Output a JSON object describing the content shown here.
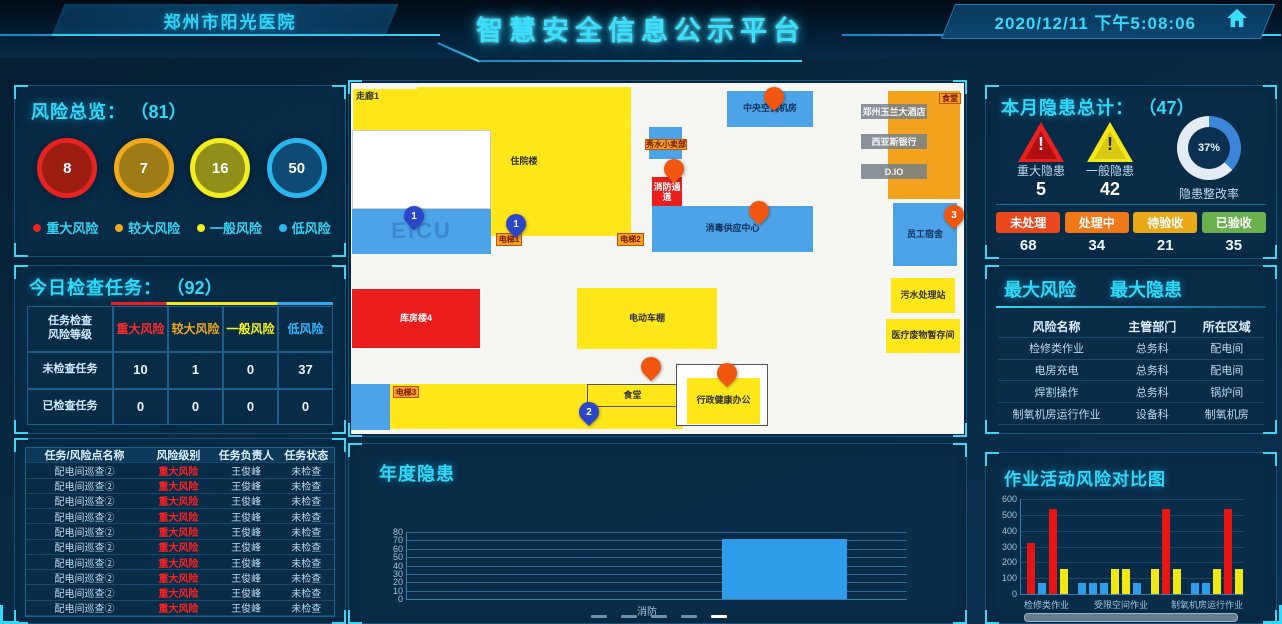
{
  "header": {
    "hospital": "郑州市阳光医院",
    "title": "智慧安全信息公示平台",
    "datetime": "2020/12/11 下午5:08:06"
  },
  "risk_overview": {
    "title": "风险总览：",
    "total": "（81）",
    "items": [
      {
        "value": "8",
        "label": "重大风险",
        "ring": "#e62222",
        "fill": "#9c1d12"
      },
      {
        "value": "7",
        "label": "较大风险",
        "ring": "#f0a81e",
        "fill": "#9c7a16"
      },
      {
        "value": "16",
        "label": "一般风险",
        "ring": "#f0ee1e",
        "fill": "#8f8f1a"
      },
      {
        "value": "50",
        "label": "低风险",
        "ring": "#29b6f0",
        "fill": "#0e4a74"
      }
    ]
  },
  "today_tasks": {
    "title": "今日检查任务：",
    "total": "（92）",
    "corner_top": "任务检查",
    "corner_bottom": "风险等级",
    "columns": [
      {
        "label": "重大风险",
        "color": "#ff2a2a"
      },
      {
        "label": "较大风险",
        "color": "#f0a81e"
      },
      {
        "label": "一般风险",
        "color": "#f5f51e"
      },
      {
        "label": "低风险",
        "color": "#35b6ff"
      }
    ],
    "rows": [
      {
        "label": "未检查任务",
        "values": [
          "10",
          "1",
          "0",
          "37"
        ]
      },
      {
        "label": "已检查任务",
        "values": [
          "0",
          "0",
          "0",
          "0"
        ]
      }
    ]
  },
  "task_detail": {
    "headers": [
      "任务/风险点名称",
      "风险级别",
      "任务负责人",
      "任务状态"
    ],
    "rows": [
      [
        "配电间巡查②",
        "重大风险",
        "王俊峰",
        "未检查"
      ],
      [
        "配电间巡查②",
        "重大风险",
        "王俊峰",
        "未检查"
      ],
      [
        "配电间巡查②",
        "重大风险",
        "王俊峰",
        "未检查"
      ],
      [
        "配电间巡查②",
        "重大风险",
        "王俊峰",
        "未检查"
      ],
      [
        "配电间巡查②",
        "重大风险",
        "王俊峰",
        "未检查"
      ],
      [
        "配电间巡查②",
        "重大风险",
        "王俊峰",
        "未检查"
      ],
      [
        "配电间巡查②",
        "重大风险",
        "王俊峰",
        "未检查"
      ],
      [
        "配电间巡查②",
        "重大风险",
        "王俊峰",
        "未检查"
      ],
      [
        "配电间巡查②",
        "重大风险",
        "王俊峰",
        "未检查"
      ],
      [
        "配电间巡查②",
        "重大风险",
        "王俊峰",
        "未检查"
      ]
    ]
  },
  "monthly_hazard": {
    "title": "本月隐患总计：",
    "total": "（47）",
    "major": {
      "label": "重大隐患",
      "value": "5"
    },
    "general": {
      "label": "一般隐患",
      "value": "42"
    },
    "donut": {
      "percent": "37%",
      "label": "隐患整改率",
      "arc_color": "#3b86d8",
      "rest_color": "#e3ebf3"
    },
    "badges": [
      {
        "label": "未处理",
        "value": "68",
        "color": "#e8481c"
      },
      {
        "label": "处理中",
        "value": "34",
        "color": "#f07818"
      },
      {
        "label": "待验收",
        "value": "21",
        "color": "#e8a818"
      },
      {
        "label": "已验收",
        "value": "35",
        "color": "#6ab04c"
      }
    ]
  },
  "top_risk": {
    "tab_risk": "最大风险",
    "tab_hazard": "最大隐患",
    "headers": [
      "风险名称",
      "主管部门",
      "所在区域"
    ],
    "rows": [
      [
        "检修类作业",
        "总务科",
        "配电间"
      ],
      [
        "电房充电",
        "总务科",
        "配电间"
      ],
      [
        "焊割操作",
        "总务科",
        "锅炉间"
      ],
      [
        "制氧机房运行作业",
        "设备科",
        "制氧机房"
      ]
    ]
  },
  "map": {
    "blocks": [
      {
        "x": 2,
        "y": 6,
        "w": 88,
        "h": 57,
        "c": "#ffe71a",
        "label": "走廊1",
        "cls": "tl"
      },
      {
        "x": 66,
        "y": 4,
        "w": 214,
        "h": 149,
        "c": "#ffe71a",
        "label": "住院楼"
      },
      {
        "x": 1,
        "y": 47,
        "w": 139,
        "h": 79,
        "c": "#ffffff",
        "label": "",
        "border": "#cccccc"
      },
      {
        "x": 1,
        "y": 126,
        "w": 139,
        "h": 45,
        "c": "#4da3e8",
        "label": "",
        "big": "EICU"
      },
      {
        "x": 376,
        "y": 8,
        "w": 86,
        "h": 36,
        "c": "#4da3e8",
        "label": "中央空调机房",
        "lc": "#10325e"
      },
      {
        "x": 298,
        "y": 44,
        "w": 33,
        "h": 32,
        "c": "#4da3e8",
        "label": ""
      },
      {
        "x": 301,
        "y": 94,
        "w": 30,
        "h": 32,
        "c": "#ea1c1c",
        "label": "消防通道",
        "lc": "#ffffff"
      },
      {
        "x": 301,
        "y": 123,
        "w": 161,
        "h": 46,
        "c": "#4da3e8",
        "label": "消毒供应中心",
        "lc": "#10325e"
      },
      {
        "x": 537,
        "y": 8,
        "w": 72,
        "h": 108,
        "c": "#f2a21c",
        "label": ""
      },
      {
        "x": 542,
        "y": 120,
        "w": 64,
        "h": 63,
        "c": "#4da3e8",
        "label": "员工宿舍",
        "lc": "#10325e"
      },
      {
        "x": 540,
        "y": 195,
        "w": 64,
        "h": 35,
        "c": "#ffe71a",
        "label": "污水处理站"
      },
      {
        "x": 535,
        "y": 236,
        "w": 74,
        "h": 34,
        "c": "#ffe71a",
        "label": "医疗废物暂存间"
      },
      {
        "x": 1,
        "y": 206,
        "w": 128,
        "h": 59,
        "c": "#ea1c1c",
        "label": "库房楼4",
        "lc": "#ffffff"
      },
      {
        "x": 226,
        "y": 205,
        "w": 140,
        "h": 61,
        "c": "#ffe71a",
        "label": "电动车棚"
      },
      {
        "x": 0,
        "y": 301,
        "w": 39,
        "h": 46,
        "c": "#4da3e8",
        "label": ""
      },
      {
        "x": 39,
        "y": 301,
        "w": 293,
        "h": 45,
        "c": "#ffe71a",
        "label": ""
      },
      {
        "x": 236,
        "y": 301,
        "w": 91,
        "h": 23,
        "c": "#ffe71a",
        "label": "食堂",
        "border": "#555555"
      },
      {
        "x": 325,
        "y": 281,
        "w": 92,
        "h": 62,
        "c": "#ffffff",
        "label": "",
        "border": "#555555"
      },
      {
        "x": 336,
        "y": 295,
        "w": 73,
        "h": 46,
        "c": "#ffe71a",
        "label": "行政健康办公"
      }
    ],
    "tags": [
      {
        "x": 294,
        "y": 56,
        "w": 42,
        "h": 11,
        "label": "秀水小卖部"
      },
      {
        "x": 588,
        "y": 10,
        "w": 22,
        "h": 11,
        "label": "食堂"
      },
      {
        "x": 42,
        "y": 303,
        "w": 26,
        "h": 12,
        "label": "电梯3"
      },
      {
        "x": 145,
        "y": 150,
        "w": 26,
        "h": 13,
        "label": "电梯1"
      },
      {
        "x": 266,
        "y": 150,
        "w": 27,
        "h": 13,
        "label": "电梯2"
      }
    ],
    "graybars": [
      {
        "x": 510,
        "y": 21,
        "w": 66,
        "h": 15,
        "label": "郑州玉兰大酒店"
      },
      {
        "x": 510,
        "y": 51,
        "w": 66,
        "h": 15,
        "label": "西亚斯银行"
      },
      {
        "x": 510,
        "y": 81,
        "w": 66,
        "h": 15,
        "label": "D.IO"
      }
    ],
    "pins": [
      {
        "x": 53,
        "y": 123,
        "t": "blue",
        "n": "1"
      },
      {
        "x": 155,
        "y": 131,
        "t": "blue",
        "n": "1"
      },
      {
        "x": 313,
        "y": 76,
        "t": "orange",
        "n": ""
      },
      {
        "x": 413,
        "y": 4,
        "t": "orange",
        "n": ""
      },
      {
        "x": 398,
        "y": 118,
        "t": "orange",
        "n": ""
      },
      {
        "x": 593,
        "y": 122,
        "t": "orange",
        "n": "3"
      },
      {
        "x": 290,
        "y": 274,
        "t": "orange",
        "n": ""
      },
      {
        "x": 366,
        "y": 280,
        "t": "orange",
        "n": ""
      },
      {
        "x": 228,
        "y": 319,
        "t": "blue",
        "n": "2"
      }
    ],
    "pin_colors": {
      "blue": "#2b46c8",
      "orange": "#f0560e"
    }
  },
  "chart_data": [
    {
      "type": "bar",
      "title": "年度隐患",
      "categories": [
        "消防"
      ],
      "values": [
        72
      ],
      "xlabel": "",
      "ylabel": "",
      "ylim": [
        0,
        80
      ],
      "ytick_step": 10,
      "grid": true,
      "bar_color": "#2e9ce8",
      "legend_position": "bottom"
    },
    {
      "type": "bar",
      "title": "作业活动风险对比图",
      "group_labels": [
        "检修类作业",
        "受限空间作业",
        "制氧机房运行作业"
      ],
      "ylim": [
        0,
        600
      ],
      "ytick_step": 100,
      "grid": true,
      "colors": {
        "red": "#e81515",
        "blue": "#2e9ce8",
        "yellow": "#f0e815"
      },
      "bars": [
        {
          "v": 320,
          "c": "red"
        },
        {
          "v": 70,
          "c": "blue"
        },
        {
          "v": 540,
          "c": "red"
        },
        {
          "v": 160,
          "c": "yellow"
        },
        {
          "v": 70,
          "c": "blue"
        },
        {
          "v": 70,
          "c": "blue"
        },
        {
          "v": 70,
          "c": "blue"
        },
        {
          "v": 160,
          "c": "yellow"
        },
        {
          "v": 160,
          "c": "yellow"
        },
        {
          "v": 70,
          "c": "blue"
        },
        {
          "v": 160,
          "c": "yellow"
        },
        {
          "v": 540,
          "c": "red"
        },
        {
          "v": 160,
          "c": "yellow"
        },
        {
          "v": 70,
          "c": "blue"
        },
        {
          "v": 70,
          "c": "blue"
        },
        {
          "v": 160,
          "c": "yellow"
        },
        {
          "v": 540,
          "c": "red"
        },
        {
          "v": 160,
          "c": "yellow"
        }
      ],
      "group_gap_after": [
        3,
        9,
        12
      ]
    }
  ]
}
